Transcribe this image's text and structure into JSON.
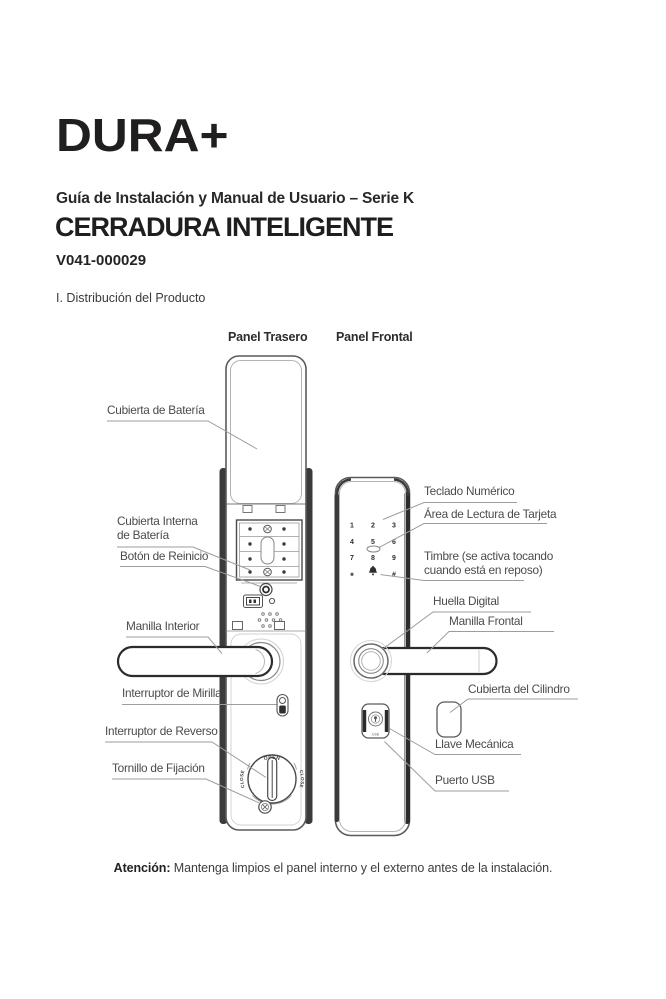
{
  "page": {
    "logo": "DURA+",
    "subtitle": "Guía de Instalación y Manual de Usuario – Serie K",
    "title": "CERRADURA INTELIGENTE",
    "model": "V041-000029",
    "section": "I. Distribución del Producto",
    "attention_label": "Atención:",
    "attention_text": " Mantenga limpios el panel interno y el externo antes de la instalación."
  },
  "diagram": {
    "rear": {
      "heading": "Panel Trasero",
      "labels": {
        "battery_cover": "Cubierta de Batería",
        "inner_battery_cover_1": "Cubierta Interna",
        "inner_battery_cover_2": "de Batería",
        "reset_button": "Botón de Reinicio",
        "inner_handle": "Manilla Interior",
        "peephole_switch": "Interruptor de Mirilla",
        "reverse_switch": "Interruptor de Reverso",
        "fixing_screw": "Tornillo de Fijación"
      }
    },
    "front": {
      "heading": "Panel Frontal",
      "labels": {
        "numeric_keypad": "Teclado Numérico",
        "card_reading_area": "Área de Lectura de Tarjeta",
        "doorbell_1": "Timbre (se activa tocando",
        "doorbell_2": "cuando está en reposo)",
        "fingerprint": "Huella Digital",
        "front_handle": "Manilla Frontal",
        "cylinder_cover": "Cubierta del Cilindro",
        "mechanical_key": "Llave Mecánica",
        "usb_port": "Puerto USB"
      },
      "icons": {
        "doorbell": "bell-icon"
      }
    },
    "keypad": {
      "keys": [
        "1",
        "2",
        "3",
        "4",
        "5",
        "6",
        "7",
        "8",
        "9",
        "*",
        "#"
      ]
    },
    "knob": {
      "open": "OPEN",
      "close_left": "CLOSE",
      "close_right": "CLOSE"
    },
    "usb_label": "USB",
    "line_color": "#9d9d9d"
  }
}
